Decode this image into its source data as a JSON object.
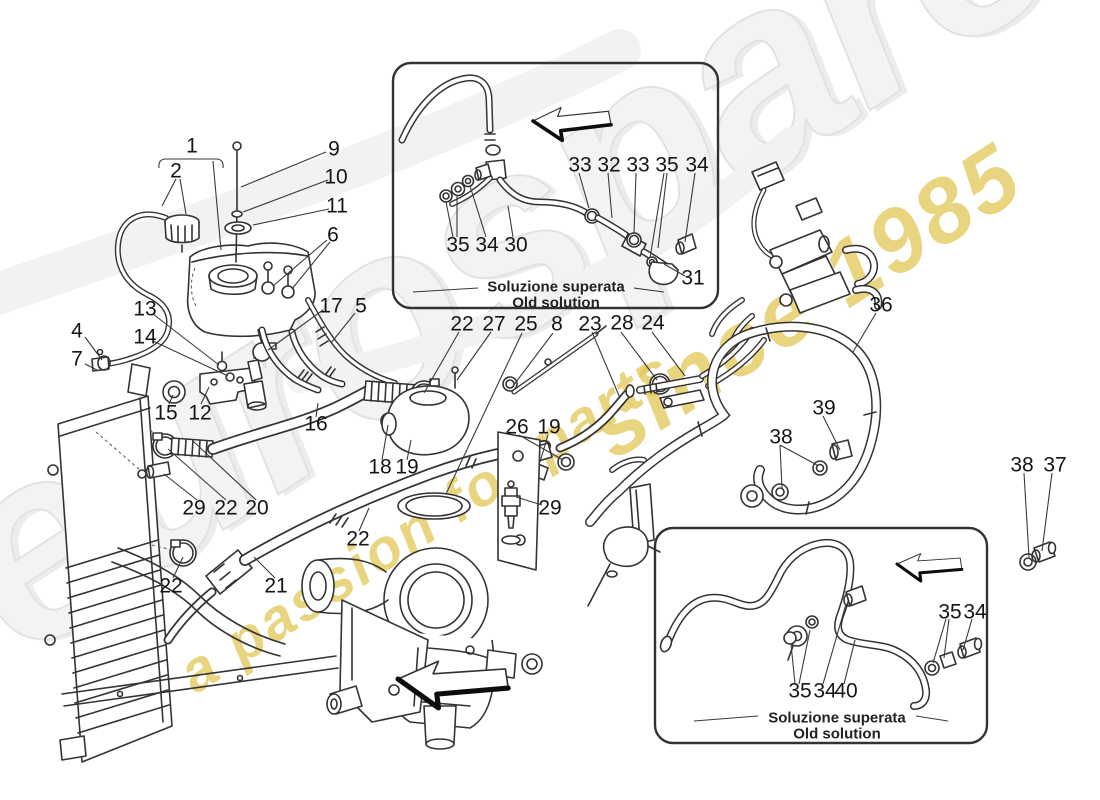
{
  "page": {
    "background_color": "#ffffff",
    "line_color": "#333333",
    "description": "Exploded parts diagram: nourice (expansion tank), radiator and cooling hoses"
  },
  "watermark": {
    "brand": "eurospares",
    "tagline_line1": "a passion for parts",
    "tagline_line2": "since 1985",
    "brand_color": "#f3f3f3",
    "tagline_color": "#e4c95c"
  },
  "icons": {
    "direction_arrow": "left-block-arrow"
  },
  "insets": [
    {
      "id": "top",
      "caption_it": "Soluzione superata",
      "caption_en": "Old solution"
    },
    {
      "id": "bottom",
      "caption_it": "Soluzione superata",
      "caption_en": "Old solution"
    }
  ],
  "callouts": [
    {
      "n": "1",
      "x": 192,
      "y": 146
    },
    {
      "n": "2",
      "x": 176,
      "y": 171
    },
    {
      "n": "9",
      "x": 334,
      "y": 149
    },
    {
      "n": "10",
      "x": 336,
      "y": 177
    },
    {
      "n": "11",
      "x": 337,
      "y": 206
    },
    {
      "n": "6",
      "x": 333,
      "y": 235
    },
    {
      "n": "4",
      "x": 77,
      "y": 331
    },
    {
      "n": "7",
      "x": 77,
      "y": 359
    },
    {
      "n": "13",
      "x": 145,
      "y": 309
    },
    {
      "n": "14",
      "x": 145,
      "y": 337
    },
    {
      "n": "17",
      "x": 331,
      "y": 306
    },
    {
      "n": "5",
      "x": 361,
      "y": 306
    },
    {
      "n": "15",
      "x": 166,
      "y": 413
    },
    {
      "n": "12",
      "x": 200,
      "y": 413
    },
    {
      "n": "16",
      "x": 316,
      "y": 424
    },
    {
      "n": "29",
      "x": 194,
      "y": 508
    },
    {
      "n": "22",
      "x": 226,
      "y": 508
    },
    {
      "n": "20",
      "x": 257,
      "y": 508
    },
    {
      "n": "22",
      "x": 171,
      "y": 586
    },
    {
      "n": "21",
      "x": 276,
      "y": 586
    },
    {
      "n": "22",
      "x": 462,
      "y": 324
    },
    {
      "n": "27",
      "x": 494,
      "y": 324
    },
    {
      "n": "25",
      "x": 526,
      "y": 324
    },
    {
      "n": "8",
      "x": 557,
      "y": 324
    },
    {
      "n": "23",
      "x": 590,
      "y": 324
    },
    {
      "n": "28",
      "x": 622,
      "y": 323
    },
    {
      "n": "24",
      "x": 653,
      "y": 323
    },
    {
      "n": "26",
      "x": 517,
      "y": 427
    },
    {
      "n": "19",
      "x": 549,
      "y": 427
    },
    {
      "n": "18",
      "x": 380,
      "y": 467
    },
    {
      "n": "19",
      "x": 407,
      "y": 467
    },
    {
      "n": "29",
      "x": 550,
      "y": 508
    },
    {
      "n": "22",
      "x": 358,
      "y": 539
    },
    {
      "n": "36",
      "x": 881,
      "y": 305
    },
    {
      "n": "39",
      "x": 824,
      "y": 408
    },
    {
      "n": "38",
      "x": 781,
      "y": 437
    },
    {
      "n": "38",
      "x": 1022,
      "y": 465
    },
    {
      "n": "37",
      "x": 1055,
      "y": 465
    },
    {
      "n": "33",
      "x": 580,
      "y": 165
    },
    {
      "n": "32",
      "x": 609,
      "y": 165
    },
    {
      "n": "33",
      "x": 638,
      "y": 165
    },
    {
      "n": "35",
      "x": 667,
      "y": 165
    },
    {
      "n": "34",
      "x": 697,
      "y": 165
    },
    {
      "n": "35",
      "x": 458,
      "y": 245
    },
    {
      "n": "34",
      "x": 487,
      "y": 245
    },
    {
      "n": "30",
      "x": 516,
      "y": 245
    },
    {
      "n": "31",
      "x": 693,
      "y": 278
    },
    {
      "n": "35",
      "x": 950,
      "y": 612
    },
    {
      "n": "34",
      "x": 975,
      "y": 612
    },
    {
      "n": "35",
      "x": 800,
      "y": 691
    },
    {
      "n": "34",
      "x": 825,
      "y": 691
    },
    {
      "n": "40",
      "x": 846,
      "y": 691
    }
  ]
}
